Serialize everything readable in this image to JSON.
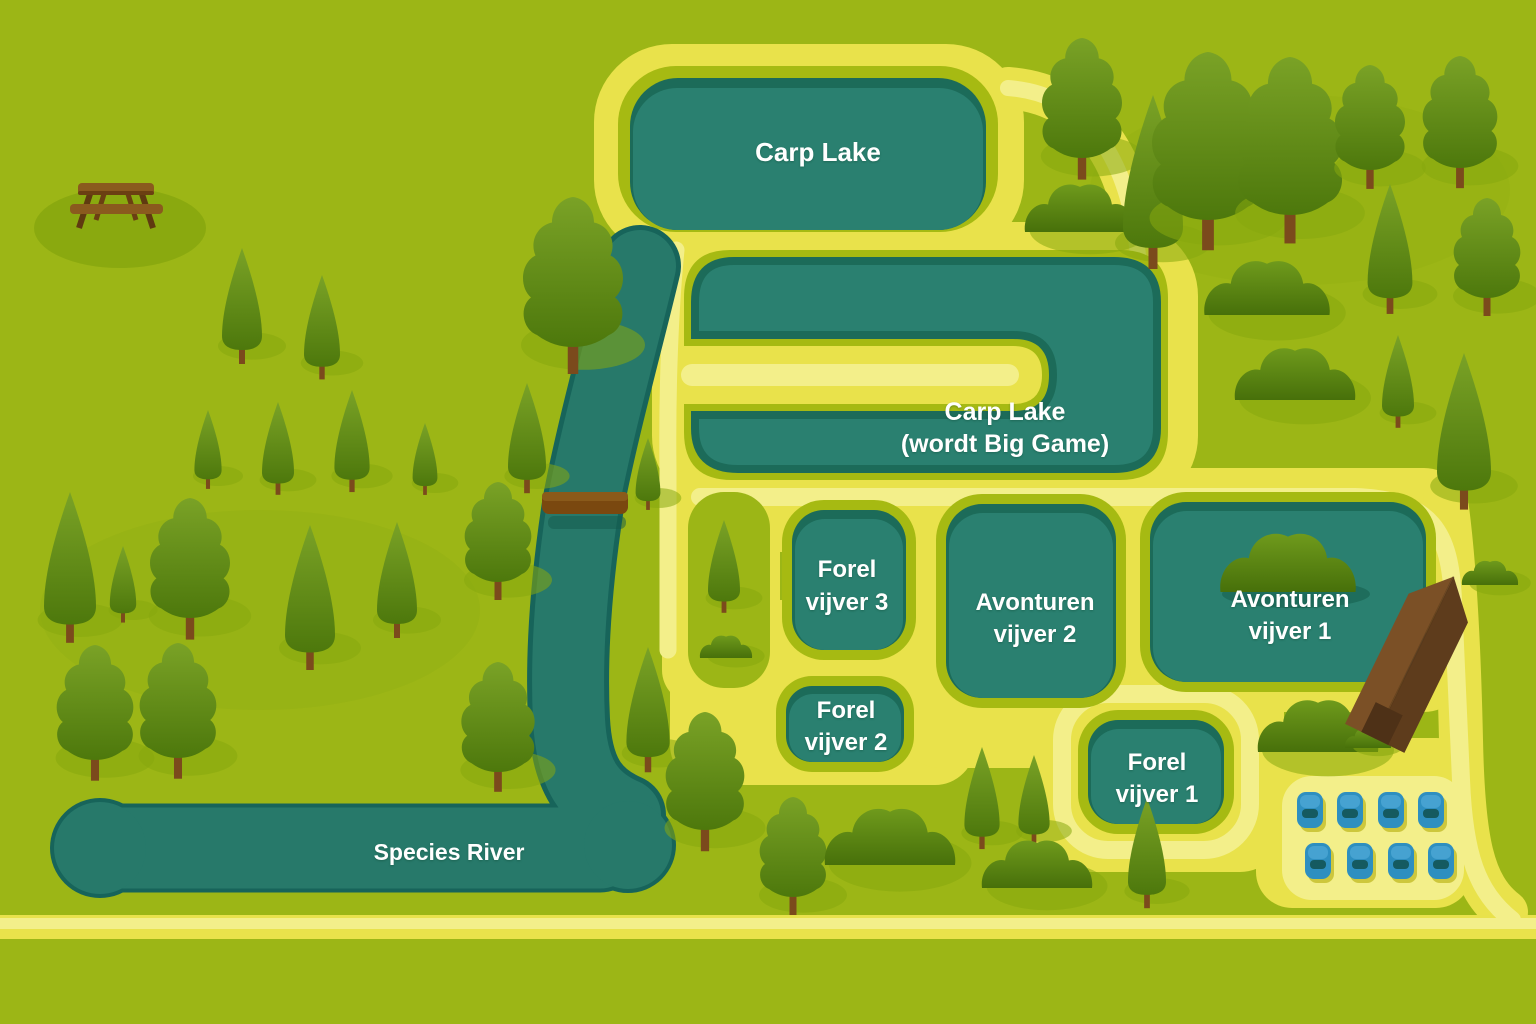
{
  "map": {
    "labels": {
      "carp_lake": "Carp Lake",
      "big_game_line1": "Carp Lake",
      "big_game_line2": "(wordt Big Game)",
      "forel3_line1": "Forel",
      "forel3_line2": "vijver 3",
      "avonturen2_line1": "Avonturen",
      "avonturen2_line2": "vijver 2",
      "avonturen1_line1": "Avonturen",
      "avonturen1_line2": "vijver 1",
      "forel2_line1": "Forel",
      "forel2_line2": "vijver 2",
      "forel1_line1": "Forel",
      "forel1_line2": "vijver 1",
      "species_river": "Species River"
    },
    "colors": {
      "background": "#9cb616",
      "shade": "#87a70e",
      "path_yellow": "#e9e24b",
      "path_light": "#f3ef8a",
      "pond_ring": "#a6ba12",
      "water": "#2a8070",
      "water_shadow": "#1c6b59",
      "river": "#27796a",
      "river_edge": "#17645a",
      "wood": "#7b4a1c",
      "building_light": "#7b5026",
      "building_dark": "#5e3c1c",
      "car_blue": "#2e8fc0"
    },
    "parking": {
      "car_count": 8
    }
  }
}
